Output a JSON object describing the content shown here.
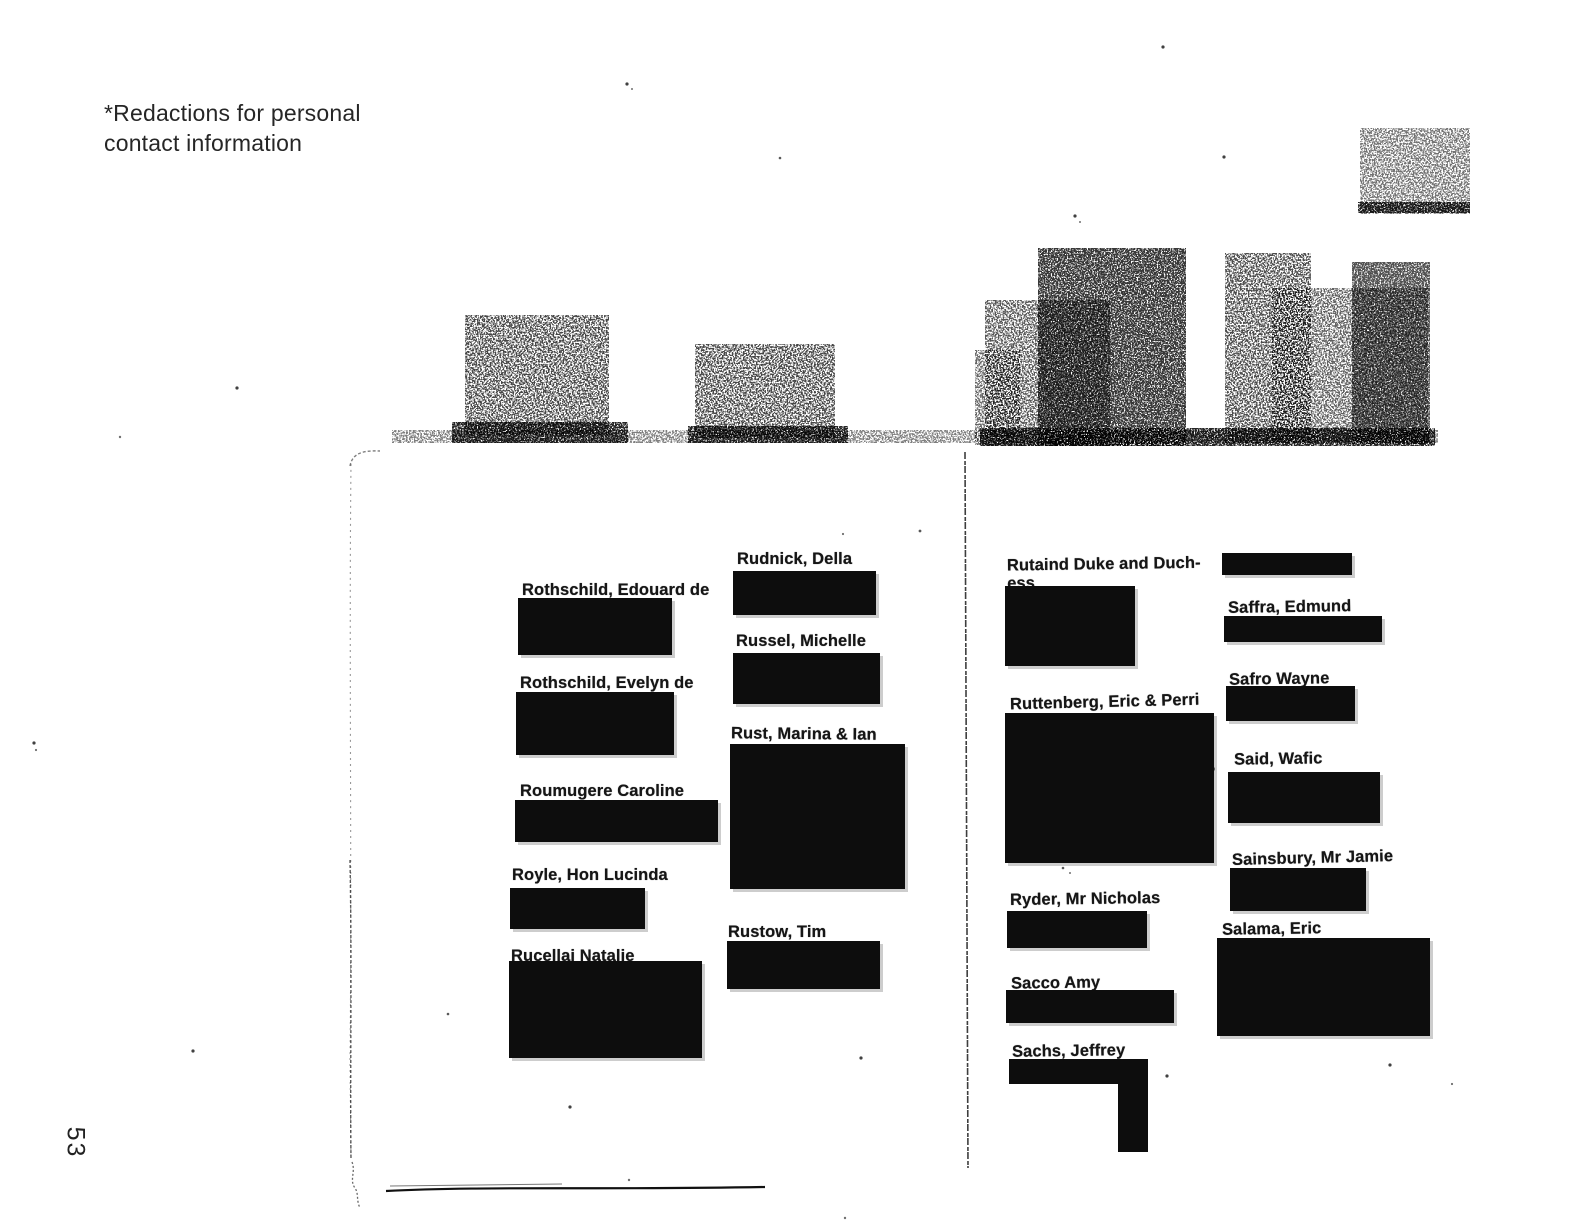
{
  "annotation": {
    "line1": "*Redactions for personal",
    "line2": "contact information"
  },
  "page_number": "53",
  "left_page": {
    "column_a": [
      {
        "name": "Rothschild, Edouard de"
      },
      {
        "name": "Rothschild, Evelyn de"
      },
      {
        "name": "Roumugere Caroline"
      },
      {
        "name": "Royle, Hon Lucinda"
      },
      {
        "name": "Rucellai Natalie"
      }
    ],
    "column_b": [
      {
        "name": "Rudnick, Della"
      },
      {
        "name": "Russel, Michelle"
      },
      {
        "name": "Rust, Marina & Ian"
      },
      {
        "name": "Rustow, Tim"
      }
    ]
  },
  "right_page": {
    "column_c": [
      {
        "name": "Rutaind Duke and Duch-",
        "name_line2": "ess"
      },
      {
        "name": "Ruttenberg, Eric & Perri"
      },
      {
        "name": "Ryder, Mr Nicholas"
      },
      {
        "name": "Sacco Amy"
      },
      {
        "name": "Sachs, Jeffrey"
      }
    ],
    "column_d": [
      {
        "name": "Saffra, Edmund"
      },
      {
        "name": "Safro Wayne"
      },
      {
        "name": "Said, Wafic"
      },
      {
        "name": "Sainsbury, Mr Jamie"
      },
      {
        "name": "Salama, Eric"
      }
    ]
  }
}
